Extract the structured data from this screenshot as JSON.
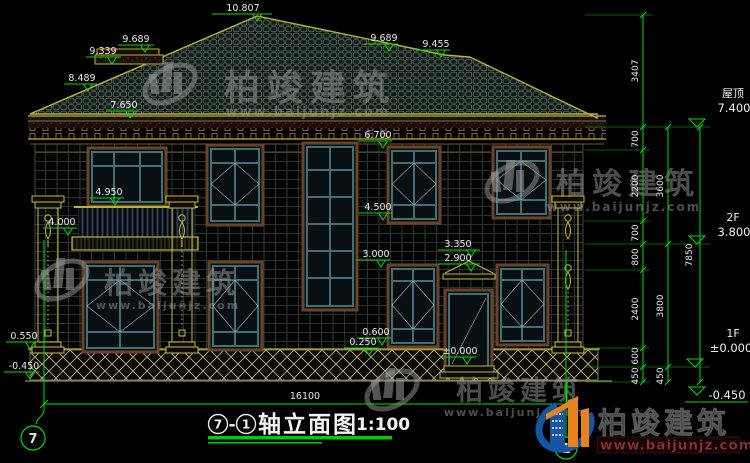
{
  "drawing": {
    "dims": {
      "peak": "10.807",
      "l9689": "9.689",
      "l9339": "9.339",
      "l8489": "8.489",
      "l7650": "7.650",
      "l4950": "4.950",
      "l4000": "4.000",
      "l0550": "0.550",
      "lm0450": "-0.450",
      "r9689": "9.689",
      "r9455": "9.455",
      "m6700": "6.700",
      "m4500": "4.500",
      "m3000": "3.000",
      "m3350": "3.350",
      "m2900": "2.900",
      "m0600": "0.600",
      "m0250": "0.250",
      "m0000": "±0.000",
      "total_width": "16100"
    },
    "chain": {
      "s3407": "3407",
      "s700a": "700",
      "s2200": "2200",
      "s700b": "700",
      "s800": "800",
      "s2400": "2400",
      "s600": "600",
      "s450a": "450",
      "s3600": "3600",
      "s3800": "3800",
      "s450b": "450",
      "s7850": "7850"
    },
    "floors": {
      "roof_name": "屋顶",
      "roof_val": "7.400",
      "f2_name": "2F",
      "f2_val": "3.800",
      "f1_name": "1F",
      "f1_val": "±0.000",
      "grade_val": "-0.450"
    },
    "axes": {
      "left": "7",
      "right": "1"
    },
    "title": {
      "axis_left": "7",
      "dash": "-",
      "axis_right": "1",
      "name": "轴立面图",
      "scale": "1:100"
    }
  },
  "watermark": {
    "brand": "柏竣建筑",
    "site": "www.baijunjz.com"
  },
  "logo": {
    "brand": "柏竣建筑",
    "site": "www.baijunjz.com"
  },
  "colors": {
    "dimension_green": "#00dc00",
    "trim_yellow": "#b8b43a",
    "window_teal": "#3f7076",
    "window_trim_brown": "#6b4226",
    "logo_blue": "#1456a0",
    "logo_orange": "#e8821e",
    "logo_url_red": "#93312d",
    "background": "#000000"
  }
}
